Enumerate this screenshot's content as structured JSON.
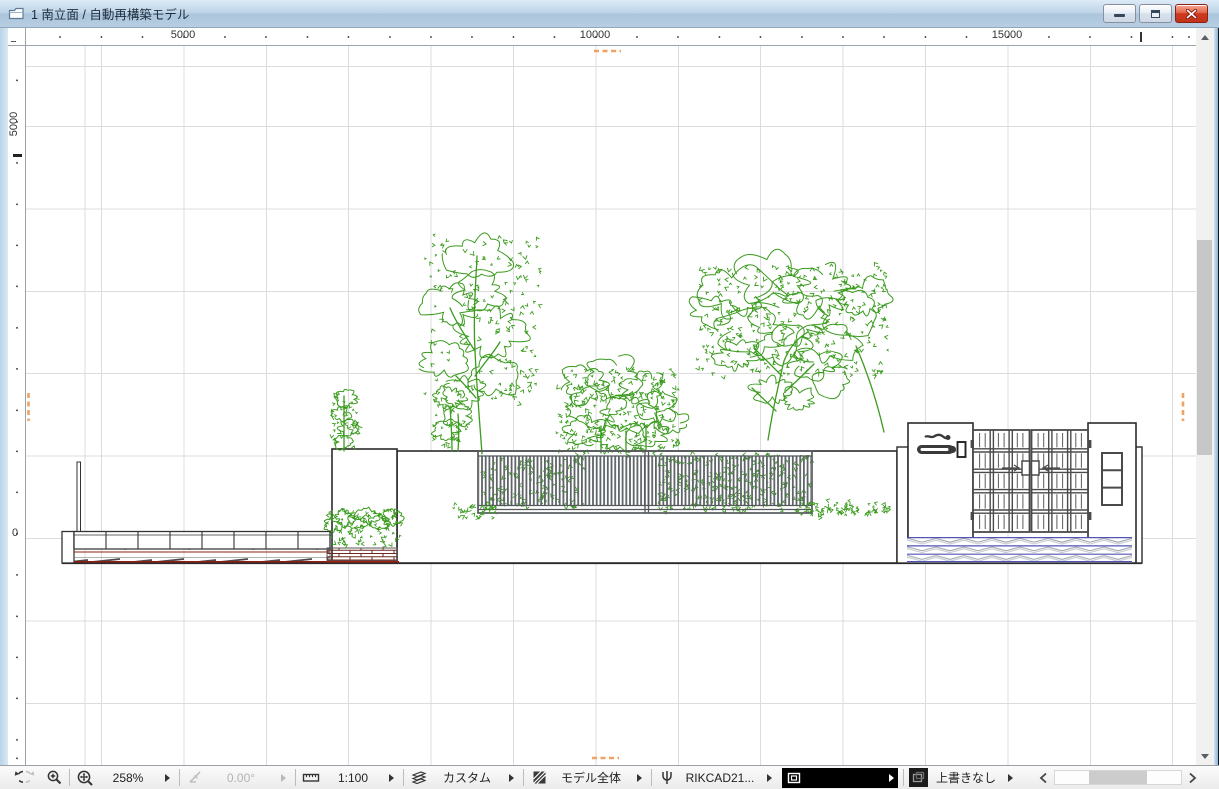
{
  "window": {
    "title": "1 南立面 / 自動再構築モデル"
  },
  "rulers": {
    "top": [
      "5000",
      "10000",
      "15000"
    ],
    "left": [
      "5000",
      "0"
    ]
  },
  "statusbar": {
    "zoom": "258%",
    "rotation": "0.00°",
    "scale": "1:100",
    "layer_combination": "カスタム",
    "view": "モデル全体",
    "pen_set": "RIKCAD21...",
    "overwrite": "上書きなし"
  },
  "colors": {
    "tree_green": "#3a9b1e",
    "fence_gray": "#5f6468",
    "outline_black": "#2b2b2b",
    "deck_red": "#8e1f12",
    "brick_red": "#6e2a20",
    "paving_blue": "#5252bb",
    "marker_orange": "#f0a264"
  }
}
